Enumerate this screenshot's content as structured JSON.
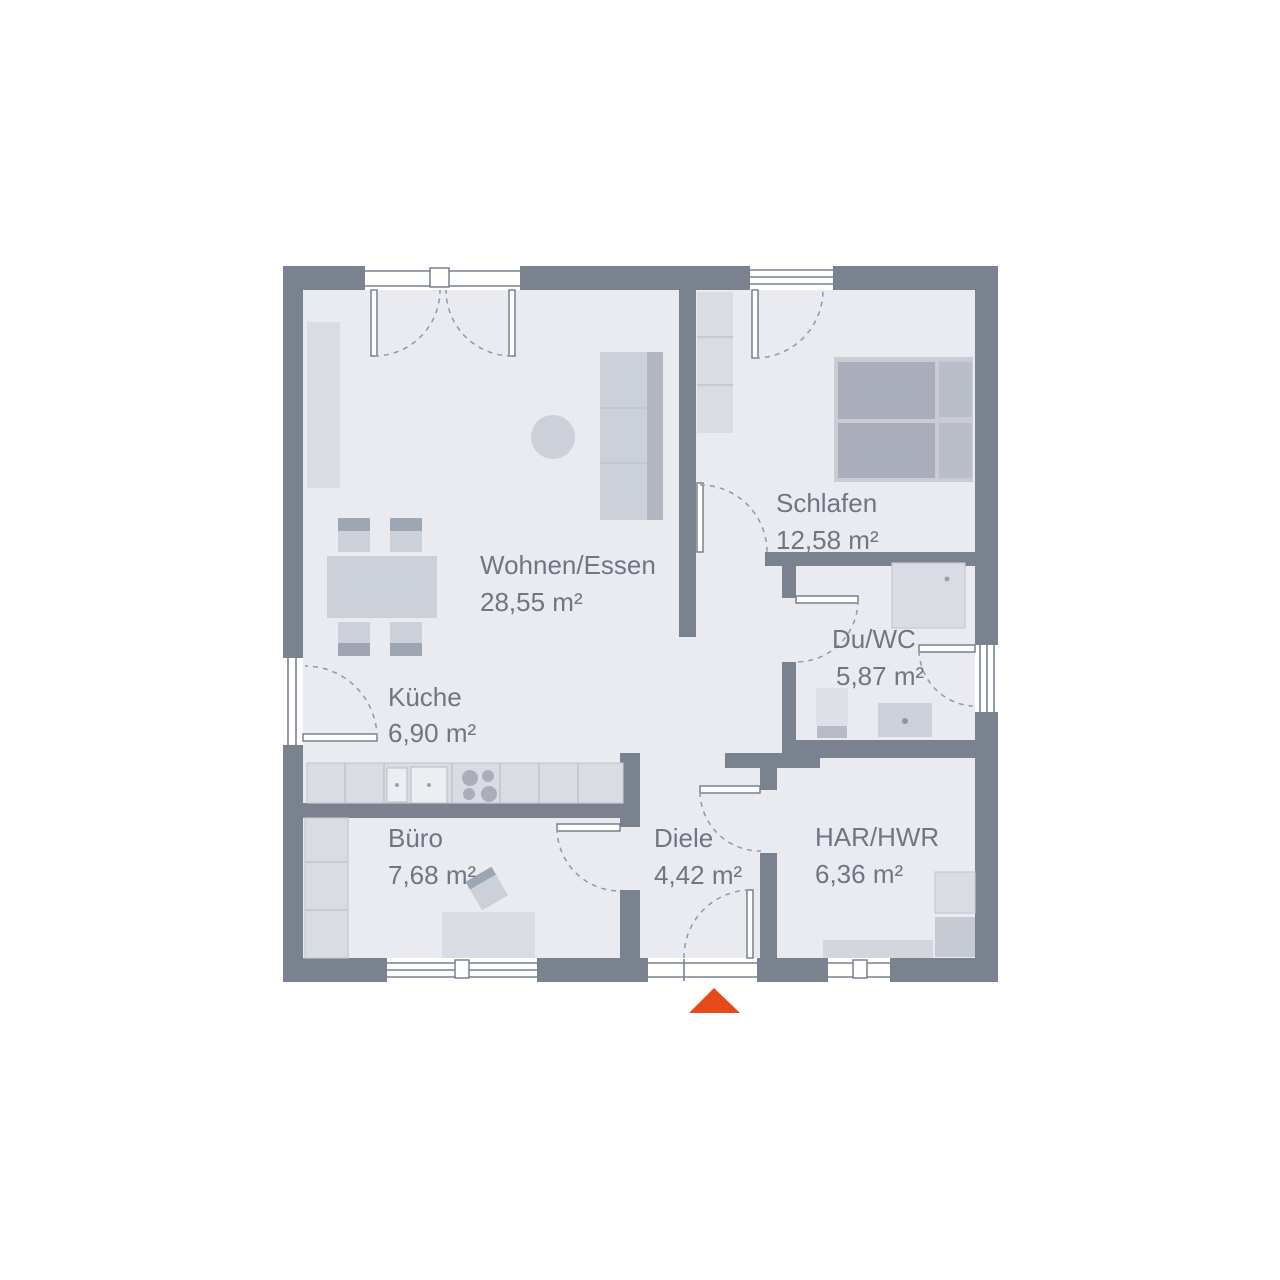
{
  "plan": {
    "type": "floor-plan",
    "rooms": {
      "wohnen": {
        "name": "Wohnen/Essen",
        "area": "28,55 m²"
      },
      "schlafen": {
        "name": "Schlafen",
        "area": "12,58 m²"
      },
      "duwc": {
        "name": "Du/WC",
        "area": "5,87 m²"
      },
      "kueche": {
        "name": "Küche",
        "area": "6,90 m²"
      },
      "buero": {
        "name": "Büro",
        "area": "7,68 m²"
      },
      "diele": {
        "name": "Diele",
        "area": "4,42 m²"
      },
      "har": {
        "name": "HAR/HWR",
        "area": "6,36 m²"
      }
    },
    "colors": {
      "wall": "#7a8290",
      "floor": "#e9ebf0",
      "furniture_light": "#d9dce2",
      "furniture_mid": "#ccd0d9",
      "furniture_dark": "#a9aeba",
      "label_text": "#6f7683",
      "entrance_accent": "#e64a19"
    },
    "entrance_marker": "triangle-up"
  }
}
